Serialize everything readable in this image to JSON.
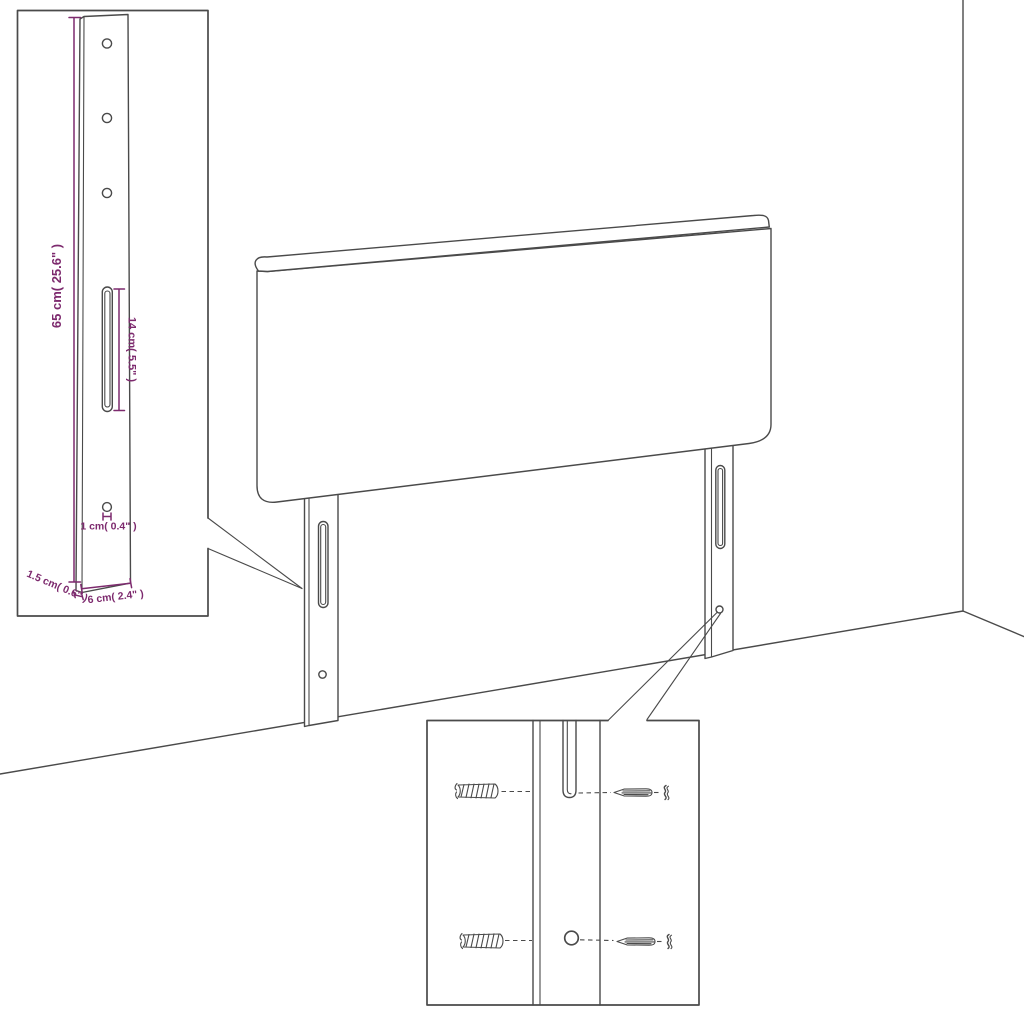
{
  "colors": {
    "line": "#4a4a4a",
    "dimension": "#7d2a6e",
    "background": "#ffffff"
  },
  "diagram": {
    "kind": "furniture-assembly-dimension-diagram",
    "subject": "headboard with two mounting legs shown against a room corner",
    "views": {
      "main": "headboard-3d-view",
      "top_left_inset": "leg-dimension-detail",
      "bottom_inset": "mounting-hardware-detail"
    }
  },
  "dimensions": {
    "leg_height": "65 cm( 25.6\" )",
    "slot_length": "14 cm( 5.5\" )",
    "hole_diameter": "1 cm( 0.4\" )",
    "leg_thickness": "1.5 cm( 0.6\" )",
    "leg_width": "6 cm( 2.4\" )"
  },
  "hardware": {
    "left_items": [
      "wall-plug-icon",
      "wall-plug-icon"
    ],
    "right_items": [
      "screw-icon",
      "screw-icon"
    ]
  }
}
